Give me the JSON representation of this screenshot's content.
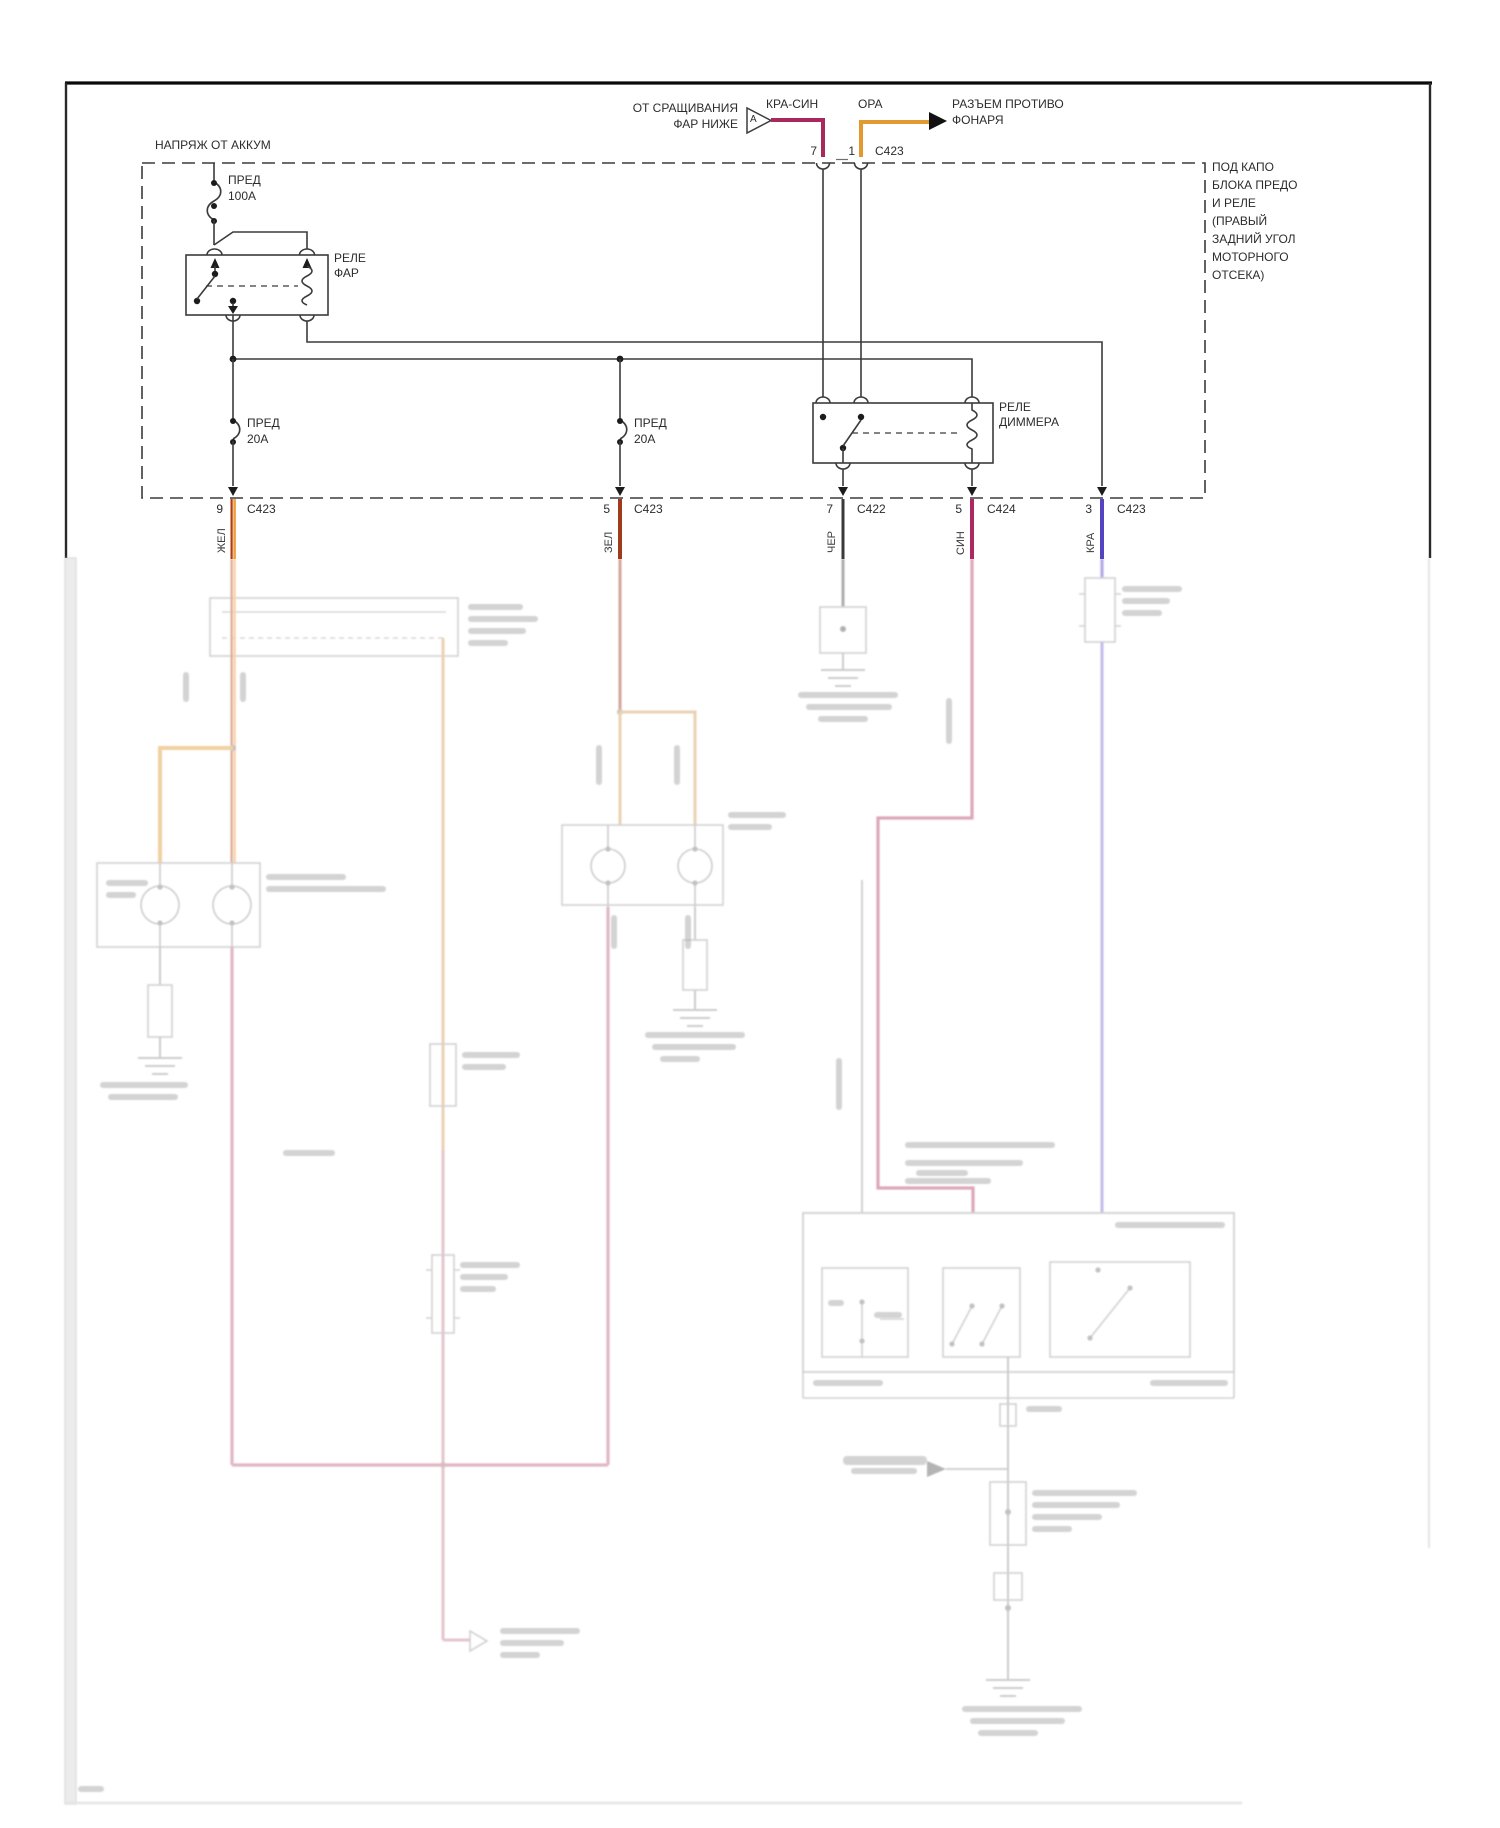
{
  "header": {
    "splice_note_line1": "ОТ СРАЩИВАНИЯ",
    "splice_note_line2": "ФАР НИЖЕ",
    "splice_marker": "А",
    "wire_label_kra_sin": "КРА-СИН",
    "wire_label_ora": "ОРА",
    "dest_line1": "РАЗЪЕМ ПРОТИВО",
    "dest_line2": "ФОНАРЯ",
    "pin_left": "7",
    "pin_right": "1",
    "connector": "C423"
  },
  "fuse_box": {
    "title": "НАПРЯЖ ОТ АККУМ",
    "location_note": [
      "ПОД КАПО",
      "БЛОКА ПРЕДО",
      "И РЕЛЕ",
      "(ПРАВЫЙ",
      "ЗАДНИЙ УГОЛ",
      "МОТОРНОГО",
      "ОТСЕКА)"
    ],
    "fuse_100": {
      "l1": "ПРЕД",
      "l2": "100А"
    },
    "relay_head": {
      "l1": "РЕЛЕ",
      "l2": "ФАР"
    },
    "fuse_20_left": {
      "l1": "ПРЕД",
      "l2": "20А"
    },
    "fuse_20_mid": {
      "l1": "ПРЕД",
      "l2": "20А"
    },
    "relay_dimmer": {
      "l1": "РЕЛЕ",
      "l2": "ДИММЕРА"
    }
  },
  "connector_pins": [
    {
      "pin": "9",
      "connector": "C423",
      "wire": "ЖЕЛ"
    },
    {
      "pin": "5",
      "connector": "C423",
      "wire": "ЗЕЛ"
    },
    {
      "pin": "7",
      "connector": "C422",
      "wire": "ЧЕР"
    },
    {
      "pin": "5",
      "connector": "C424",
      "wire": "СИН"
    },
    {
      "pin": "3",
      "connector": "C423",
      "wire": "КРА"
    }
  ],
  "colors": {
    "wire_kra_sin": "#a8295c",
    "wire_ora": "#e2992f",
    "wire_zhel": "#efa041",
    "wire_zel": "#a03a1c",
    "wire_chjor": "#3a3a3a",
    "wire_sin": "#ad2760",
    "wire_kra": "#5443c2"
  }
}
